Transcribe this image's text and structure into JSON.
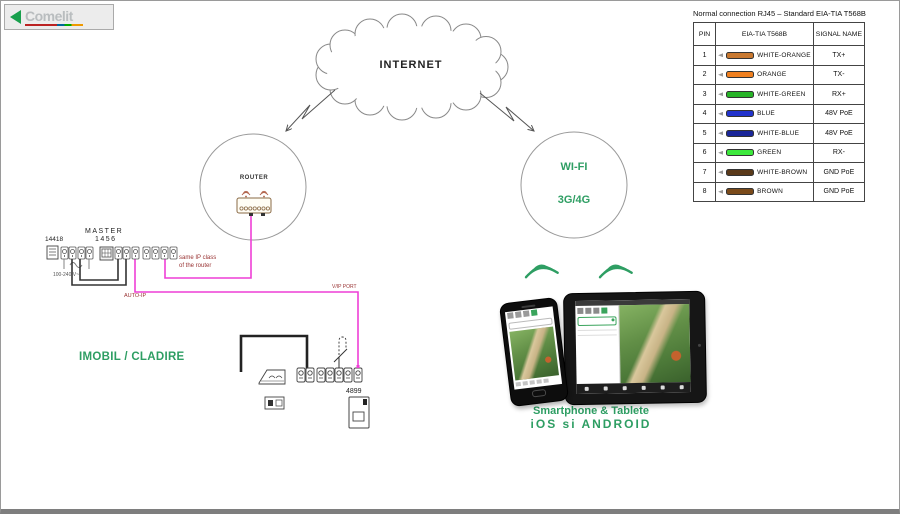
{
  "logo": {
    "brand": "Comelit"
  },
  "internet_cloud": {
    "label": "INTERNET"
  },
  "router": {
    "label": "ROUTER"
  },
  "wifi": {
    "line1": "WI-FI",
    "line2": "3G/4G"
  },
  "left_devices": {
    "psu_label": "14418",
    "master_label": "MASTER",
    "master_model": "1456",
    "power_label": "100-240 V~",
    "auto_ip": "AUTO-IP",
    "same_ip_line1": "same IP class",
    "same_ip_line2": "of the router",
    "vip_port": "V/IP PORT",
    "building_label": "IMOBIL / CLADIRE",
    "door_module": "4899"
  },
  "mobile": {
    "caption1": "Smartphone & Tablete",
    "caption2": "iOS  si  ANDROID"
  },
  "wiring_table": {
    "title": "Normal connection RJ45 – Standard EIA-TIA T568B",
    "headers": {
      "pin": "PIN",
      "wire": "EIA-TIA T568B",
      "signal": "SIGNAL NAME"
    },
    "rows": [
      {
        "pin": "1",
        "name": "WHITE-ORANGE",
        "signal": "TX+",
        "color": "#c87830"
      },
      {
        "pin": "2",
        "name": "ORANGE",
        "signal": "TX-",
        "color": "#f08020"
      },
      {
        "pin": "3",
        "name": "WHITE-GREEN",
        "signal": "RX+",
        "color": "#28b428"
      },
      {
        "pin": "4",
        "name": "BLUE",
        "signal": "48V PoE",
        "color": "#2233cc"
      },
      {
        "pin": "5",
        "name": "WHITE-BLUE",
        "signal": "48V PoE",
        "color": "#1a2699"
      },
      {
        "pin": "6",
        "name": "GREEN",
        "signal": "RX-",
        "color": "#3ce83c"
      },
      {
        "pin": "7",
        "name": "WHITE-BROWN",
        "signal": "GND PoE",
        "color": "#5a3a1a"
      },
      {
        "pin": "8",
        "name": "BROWN",
        "signal": "GND PoE",
        "color": "#7a4a1a"
      }
    ]
  },
  "colors": {
    "accent_green": "#2E9E63",
    "wire_magenta": "#EE3FD6",
    "label_red": "#993333",
    "logo_green": "#18A04D"
  }
}
